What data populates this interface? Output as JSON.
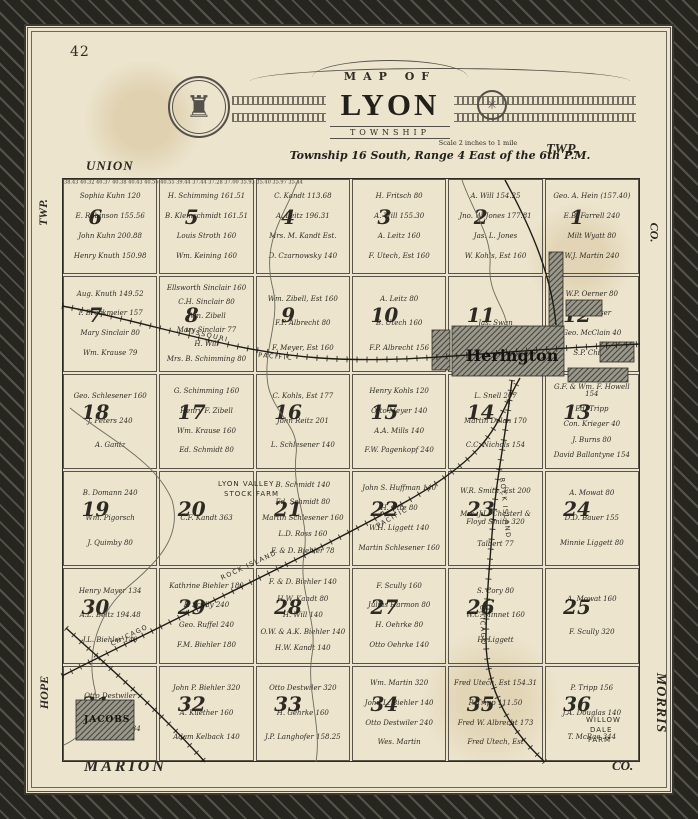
{
  "page_number": "42",
  "title": {
    "kicker": "MAP OF",
    "name": "LYON",
    "type": "TOWNSHIP",
    "scale": "Scale 2 inches to 1 mile",
    "legal": "Township 16 South, Range 4 East of the 6th P.M."
  },
  "edge_labels": {
    "top_left": "UNION",
    "top_right": "TWP.",
    "left_top": "TWP.",
    "left_bottom": "HOPE",
    "right_top": "CO.",
    "right_bottom": "MORRIS",
    "bottom_left": "MARION",
    "bottom_right": "CO."
  },
  "towns": {
    "herington": "Herington",
    "jacobs": "JACOBS"
  },
  "farms": {
    "lyon_valley": [
      "LYON VALLEY",
      "STOCK FARM"
    ],
    "willow_dale": [
      "WILLOW",
      "DALE",
      "FARM"
    ]
  },
  "rail_labels": {
    "missouri": "MISSOURI",
    "pacific": "PACIFIC",
    "chicago": "CHICAGO",
    "rock_island": "ROCK ISLAND"
  },
  "survey_numbers": "38.43 40.32 40.37 40.38 40.43 40.56 40.55 39.44 37.44 37.28 37.00 35.93 35.40 35.97 35.44",
  "sections": [
    {
      "num": "6",
      "owners": [
        "Sophia Kuhn 120",
        "E. Robinson 155.56",
        "John Kuhn 200.88",
        "Henry Knuth 150.98"
      ]
    },
    {
      "num": "5",
      "owners": [
        "H. Schimming 161.51",
        "B. Kleinschmidt 161.51",
        "Louis Stroth 160",
        "Wm. Keining 160"
      ]
    },
    {
      "num": "4",
      "owners": [
        "C. Kandt 113.68",
        "A. Leitz 196.31",
        "Mrs. M. Kandt Est.",
        "D. Czarnowsky 140"
      ]
    },
    {
      "num": "3",
      "owners": [
        "H. Fritsch 80",
        "A. Will 155.30",
        "A. Leitz 160",
        "F. Utech, Est 160"
      ]
    },
    {
      "num": "2",
      "owners": [
        "A. Will 154.25",
        "Jno. W. Jones 177.81",
        "Jas. L. Jones",
        "W. Kohls, Est 160"
      ]
    },
    {
      "num": "1",
      "owners": [
        "Geo. A. Hein (157.40)",
        "E.B. Farrell 240",
        "Milt Wyatt 80",
        "W.J. Martin 240"
      ]
    },
    {
      "num": "7",
      "owners": [
        "Aug. Knuth 149.52",
        "T. Brockmeier 157",
        "Mary Sinclair 80",
        "Wm. Krause 79"
      ]
    },
    {
      "num": "8",
      "owners": [
        "Ellsworth Sinclair 160",
        "C.H. Sinclair 80",
        "Wm. Zibell",
        "Mary Sinclair 77",
        "H. Will",
        "Mrs. B. Schimming 80"
      ]
    },
    {
      "num": "9",
      "owners": [
        "Wm. Zibell, Est 160",
        "F.P. Albrecht 80",
        "F. Meyer, Est 160"
      ]
    },
    {
      "num": "10",
      "owners": [
        "A. Leitz 80",
        "B. Utech 160",
        "F.P. Albrecht 156"
      ]
    },
    {
      "num": "11",
      "owners": [
        "Jas. Swan"
      ]
    },
    {
      "num": "12",
      "owners": [
        "W.P. Oerner 80",
        "J.E. Kooser",
        "Geo. McClain 40",
        "S.P. Childs"
      ]
    },
    {
      "num": "18",
      "owners": [
        "Geo. Schlesener 160",
        "J. Peters 240",
        "A. Gantz"
      ]
    },
    {
      "num": "17",
      "owners": [
        "G. Schimming 160",
        "Henry F. Zibell",
        "Wm. Krause 160",
        "Ed. Schmidt 80"
      ]
    },
    {
      "num": "16",
      "owners": [
        "C. Kohls, Est 177",
        "John Reitz 201",
        "L. Schlesener 140"
      ]
    },
    {
      "num": "15",
      "owners": [
        "Henry Kohls 120",
        "Otto Meyer 140",
        "A.A. Mills 140",
        "F.W. Pagenkopf 240"
      ]
    },
    {
      "num": "14",
      "owners": [
        "L. Snell 207",
        "Martin Dolan 170",
        "C.C. Nichols 154"
      ]
    },
    {
      "num": "13",
      "owners": [
        "G.F. & Wm. F. Howell 154",
        "Ed. Tripp",
        "Con. Krieger 40",
        "J. Burns 80",
        "David Ballantyne 154"
      ]
    },
    {
      "num": "19",
      "owners": [
        "B. Domann 240",
        "Wm. Pigorsch",
        "J. Quimby 80"
      ]
    },
    {
      "num": "20",
      "owners": [
        "C.F. Kandt 363"
      ]
    },
    {
      "num": "21",
      "owners": [
        "B. Schmidt 140",
        "Ed. Schmidt 80",
        "Martin Schlesener 160",
        "L.D. Ross 160",
        "F. & D. Biehler 78"
      ]
    },
    {
      "num": "22",
      "owners": [
        "John S. Huffman 140",
        "H. Otte 80",
        "W.H. Liggett 140",
        "Martin Schlesener 160"
      ]
    },
    {
      "num": "23",
      "owners": [
        "W.R. Smith, Est 200",
        "Mrs. J.L. Chesterl & Floyd Smith 320",
        "Talbert 77"
      ]
    },
    {
      "num": "24",
      "owners": [
        "A. Mowat 80",
        "D.D. Bauer 155",
        "Minnie Liggett 80"
      ]
    },
    {
      "num": "30",
      "owners": [
        "Henry Mayer 134",
        "A.L. Beltz 194.48",
        "J.L. Biehler 140"
      ]
    },
    {
      "num": "29",
      "owners": [
        "Kathrine Biehler 180",
        "F. Scully 240",
        "Geo. Ruffel 240",
        "F.M. Biehler 180"
      ]
    },
    {
      "num": "28",
      "owners": [
        "F. & D. Biehler 140",
        "H.W. Kandt 80",
        "H. Will 140",
        "O.W. & A.K. Biehler 140",
        "H.W. Kandt 140"
      ]
    },
    {
      "num": "27",
      "owners": [
        "F. Scully 160",
        "Julius Harmon 80",
        "H. Oehrke 80",
        "Otto Oehrke 140"
      ]
    },
    {
      "num": "26",
      "owners": [
        "S. Cory 80",
        "W.C. Minnet 160",
        "H. Liggett"
      ]
    },
    {
      "num": "25",
      "owners": [
        "A. Mowat 160",
        "F. Scully 320"
      ]
    },
    {
      "num": "31",
      "owners": [
        "Otto Destwiler",
        "A.L. Beltz 218.34"
      ]
    },
    {
      "num": "32",
      "owners": [
        "John P. Biehler 320",
        "A. Kuether 160",
        "Adam Kelback 140"
      ]
    },
    {
      "num": "33",
      "owners": [
        "Otto Destwiler 320",
        "H. Gehrke 160",
        "J.P. Langhofer 158.25"
      ]
    },
    {
      "num": "34",
      "owners": [
        "Wm. Martin 320",
        "John L. Biehler 140",
        "Otto Destwiler 240",
        "Wes. Martin"
      ]
    },
    {
      "num": "35",
      "owners": [
        "Fred Utech, Est 154.31",
        "P. Tripp 111.50",
        "Fred W. Albrecht 173",
        "Fred Utech, Est"
      ]
    },
    {
      "num": "36",
      "owners": [
        "P. Tripp 156",
        "J.A. Douglas 140",
        "T. McRae 344"
      ]
    }
  ]
}
